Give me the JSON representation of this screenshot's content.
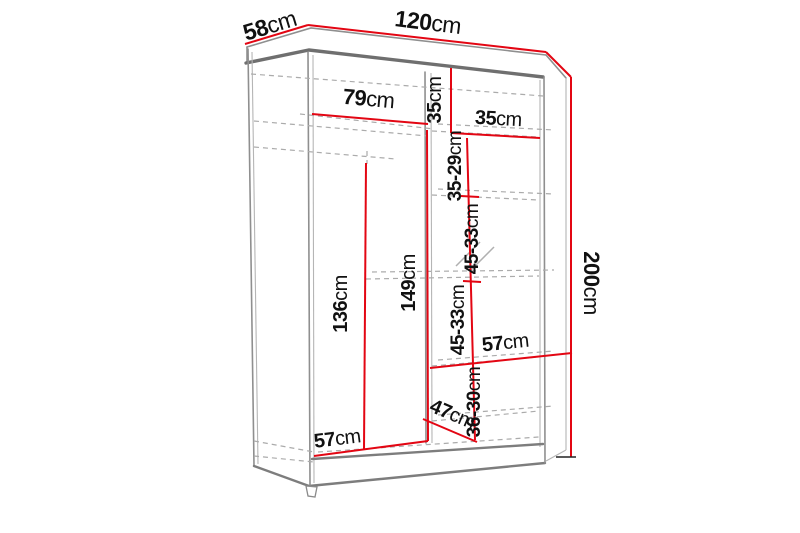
{
  "title": "Wardrobe dimension diagram",
  "colors": {
    "dimension_line": "#e30613",
    "outline": "#8f8f8f",
    "text": "#111111",
    "background": "#ffffff"
  },
  "dims": {
    "depth_top": {
      "value": "58",
      "unit": "cm"
    },
    "width_top": {
      "value": "120",
      "unit": "cm"
    },
    "height_right": {
      "value": "200",
      "unit": "cm"
    },
    "left_width": {
      "value": "79",
      "unit": "cm"
    },
    "right_top_height": {
      "value": "35",
      "unit": "cm"
    },
    "right_width": {
      "value": "35",
      "unit": "cm"
    },
    "gap1": {
      "value": "35-29",
      "unit": "cm"
    },
    "gap2": {
      "value": "45-33",
      "unit": "cm"
    },
    "gap3": {
      "value": "45-33",
      "unit": "cm"
    },
    "mid_height": {
      "value": "149",
      "unit": "cm"
    },
    "rail_height": {
      "value": "136",
      "unit": "cm"
    },
    "right_lower_width": {
      "value": "57",
      "unit": "cm"
    },
    "gap4": {
      "value": "36-30",
      "unit": "cm"
    },
    "bottom_depth": {
      "value": "47",
      "unit": "cm"
    },
    "bottom_left_width": {
      "value": "57",
      "unit": "cm"
    }
  }
}
